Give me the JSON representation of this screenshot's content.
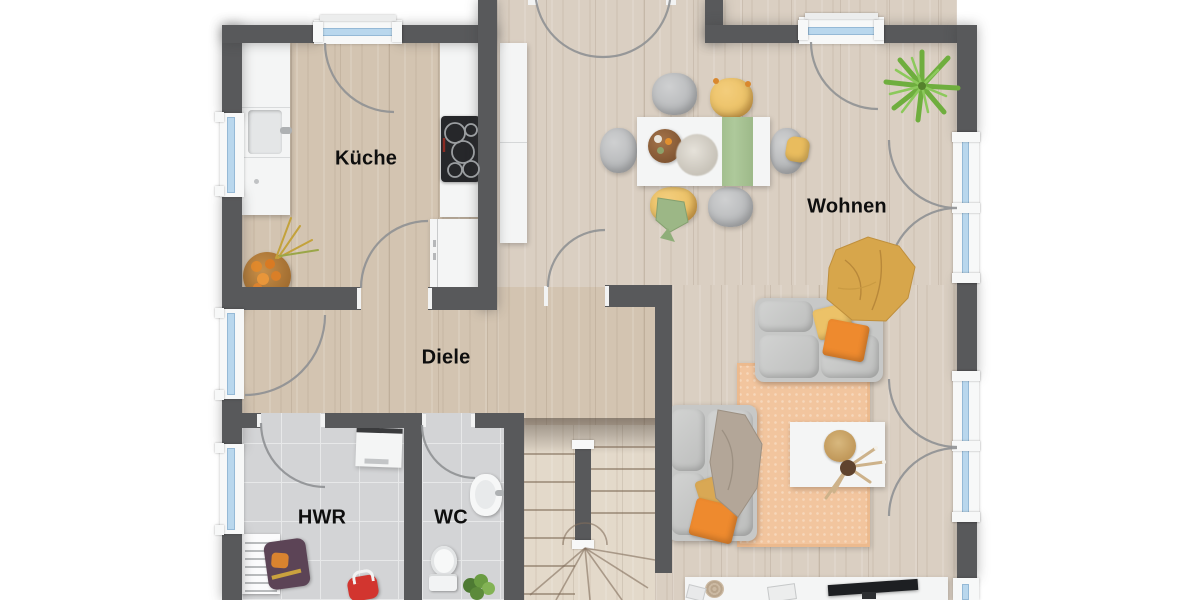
{
  "floorplan": {
    "rooms": [
      {
        "id": "kueche",
        "label": "Küche"
      },
      {
        "id": "wohnen",
        "label": "Wohnen"
      },
      {
        "id": "diele",
        "label": "Diele"
      },
      {
        "id": "hwr",
        "label": "HWR"
      },
      {
        "id": "wc",
        "label": "WC"
      }
    ],
    "colors": {
      "wall": "#58595b",
      "wood_warm": "#d3c4b1",
      "wood_light": "#dacfc2",
      "wood_stairs": "#e3d9ca",
      "tile": "#d3d4d6",
      "tile_grout": "#e7e8e9",
      "frame_white": "#f7f8f8",
      "glass_blue": "#b9d7ed",
      "door_arc": "#8f9194",
      "rug_salmon": "#f2c59e",
      "sofa_gray": "#c7c8c7",
      "pillow_orange": "#ee8a2e",
      "pillow_yellow": "#ecc268",
      "runner_green": "#aec99b",
      "blanket_mustard": "#d7a64b",
      "blanket_taupe": "#b3a698",
      "palm_green": "#6fae3e",
      "label_black": "#0e0e0e"
    }
  }
}
